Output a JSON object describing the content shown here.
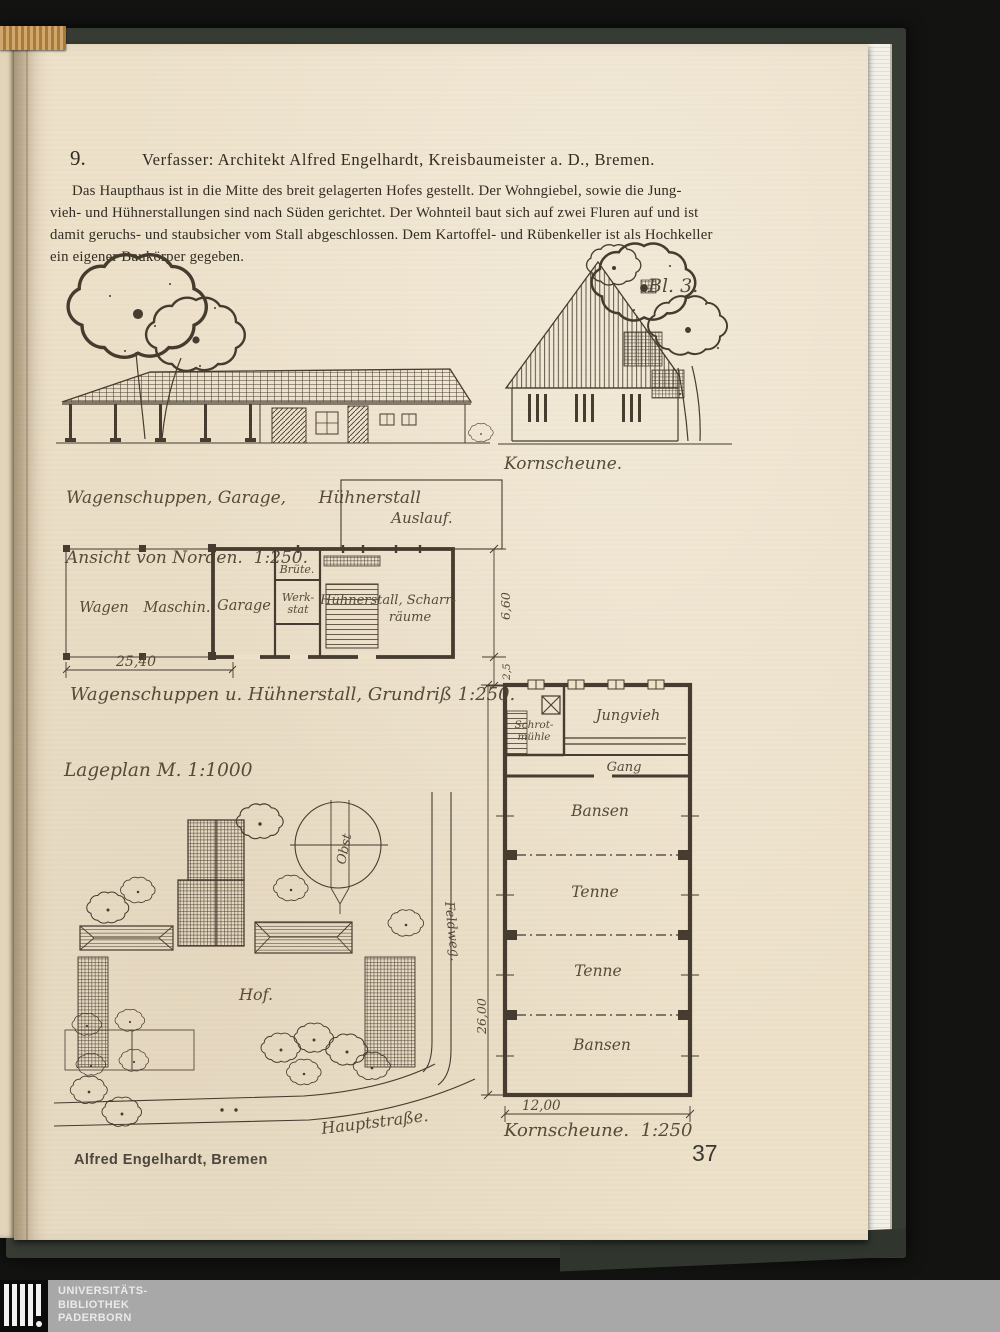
{
  "print": {
    "item_number": "9.",
    "header": "Verfasser: Architekt Alfred Engelhardt, Kreisbaumeister a. D., Bremen.",
    "body": [
      "Das Haupthaus ist in die Mitte des breit gelagerten Hofes gestellt. Der Wohngiebel, sowie die Jung-",
      "vieh- und Hühnerstallungen sind nach Süden gerichtet. Der Wohnteil baut sich auf zwei Fluren auf und ist",
      "damit geruchs- und staubsicher vom Stall abgeschlossen. Dem Kartoffel- und Rübenkeller ist als Hochkeller",
      "ein eigener Baukörper gegeben."
    ],
    "credit": "Alfred Engelhardt, Bremen",
    "page_number": "37"
  },
  "elevation_left": {
    "caption_line1": "Wagenschuppen, Garage,      Hühnerstall",
    "caption_line2": "Ansicht von Norden.  1:250."
  },
  "elevation_right": {
    "sheet_label": "Bl. 3.",
    "caption": "Kornscheune."
  },
  "floor_plan": {
    "caption": "Wagenschuppen u. Hühnerstall, Grundriß 1:250.",
    "auslauf_label": "Auslauf.",
    "rooms": [
      "Wagen",
      "Maschin.",
      "Garage",
      "Brüte.",
      "Werk-",
      "stat",
      "Hühnerstall, Scharr-",
      "räume"
    ],
    "dim_width": "25,40",
    "dim_depth": "6,60",
    "dim_small": "2,5"
  },
  "site_plan": {
    "title": "Lageplan M. 1:1000",
    "hof": "Hof.",
    "obst": "Obst",
    "hauptstrasse": "Hauptstraße.",
    "feldweg": "Feldweg."
  },
  "barn_plan": {
    "caption": "Kornscheune.  1:250",
    "rooms": {
      "schrot1": "Schrot-",
      "schrot2": "mühle",
      "jungvieh": "Jungvieh",
      "gang": "Gang",
      "bansen_top": "Bansen",
      "tenne1": "Tenne",
      "tenne2": "Tenne",
      "bansen_bottom": "Bansen"
    },
    "dim_height": "26,00",
    "dim_width": "12,00"
  },
  "scan_overlay": {
    "library": [
      "UNIVERSITÄTS-",
      "BIBLIOTHEK",
      "PADERBORN"
    ]
  },
  "colors": {
    "paper": "#ede1ca",
    "ink": "#463c2f",
    "cover": "#363c34",
    "band": "#a8a8a8",
    "tape": "#c08a3e"
  }
}
